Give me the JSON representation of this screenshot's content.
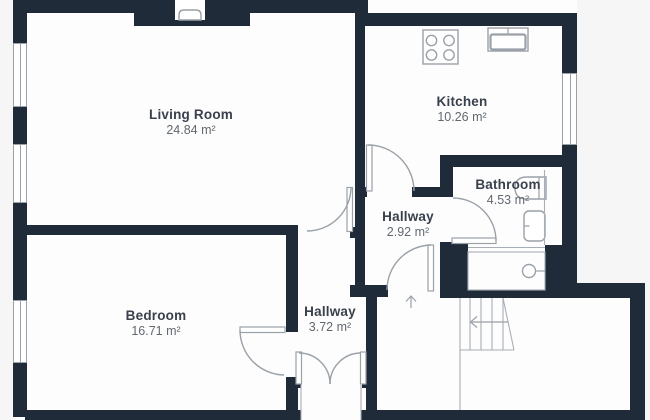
{
  "title": "Apartment floor plan",
  "rooms": [
    {
      "id": "living-room",
      "name": "Living Room",
      "area": "24.84 m²"
    },
    {
      "id": "kitchen",
      "name": "Kitchen",
      "area": "10.26 m²"
    },
    {
      "id": "bathroom",
      "name": "Bathroom",
      "area": "4.53 m²"
    },
    {
      "id": "hallway-upper",
      "name": "Hallway",
      "area": "2.92 m²"
    },
    {
      "id": "hallway-lower",
      "name": "Hallway",
      "area": "3.72 m²"
    },
    {
      "id": "bedroom",
      "name": "Bedroom",
      "area": "16.71 m²"
    }
  ],
  "symbols": {
    "stairs_arrow_direction": "left",
    "entrance_arrow_direction": "up",
    "fixtures": [
      "stove-icon",
      "sink-icon",
      "toilet-icon",
      "washbasin-icon",
      "boiler-icon",
      "chimney-flue-icon"
    ]
  },
  "colors": {
    "wall": "#202b3a",
    "fixture_stroke": "#9aa1a8",
    "thin_line": "#a8aeb5",
    "title_text": "#3a414d",
    "area_text": "#616870",
    "background": "#f6f6f6",
    "floor": "#fdfdfd"
  }
}
